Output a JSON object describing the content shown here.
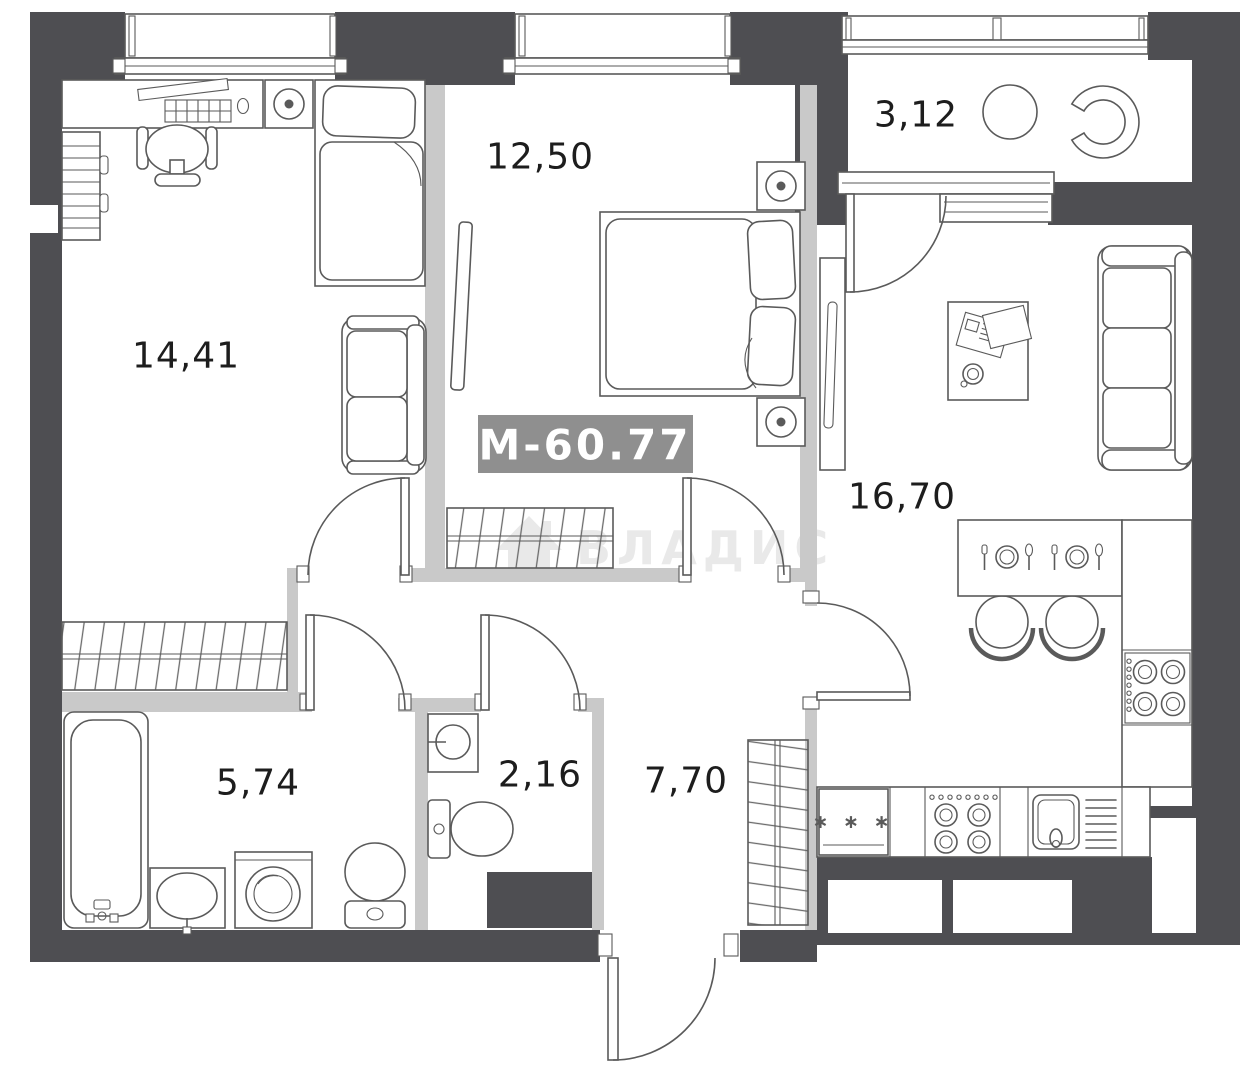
{
  "badge": {
    "label": "М-60.77"
  },
  "watermark": {
    "label": "ВЛАДИС"
  },
  "rooms": [
    {
      "id": "room-14",
      "area": "14,41"
    },
    {
      "id": "room-12",
      "area": "12,50"
    },
    {
      "id": "balcony",
      "area": "3,12"
    },
    {
      "id": "kitchen-living",
      "area": "16,70"
    },
    {
      "id": "bathroom",
      "area": "5,74"
    },
    {
      "id": "wc",
      "area": "2,16"
    },
    {
      "id": "hallway",
      "area": "7,70"
    }
  ],
  "kitchen": {
    "fridge_label": "∗ ∗ ∗"
  },
  "colors": {
    "wall": "#4e4e52",
    "partition": "#c9c9c9",
    "line": "#5a5a5a",
    "label": "#1d1d1d",
    "badge_bg": "#8f8f8f",
    "badge_text": "#ffffff",
    "watermark": "#e9e9e9"
  }
}
